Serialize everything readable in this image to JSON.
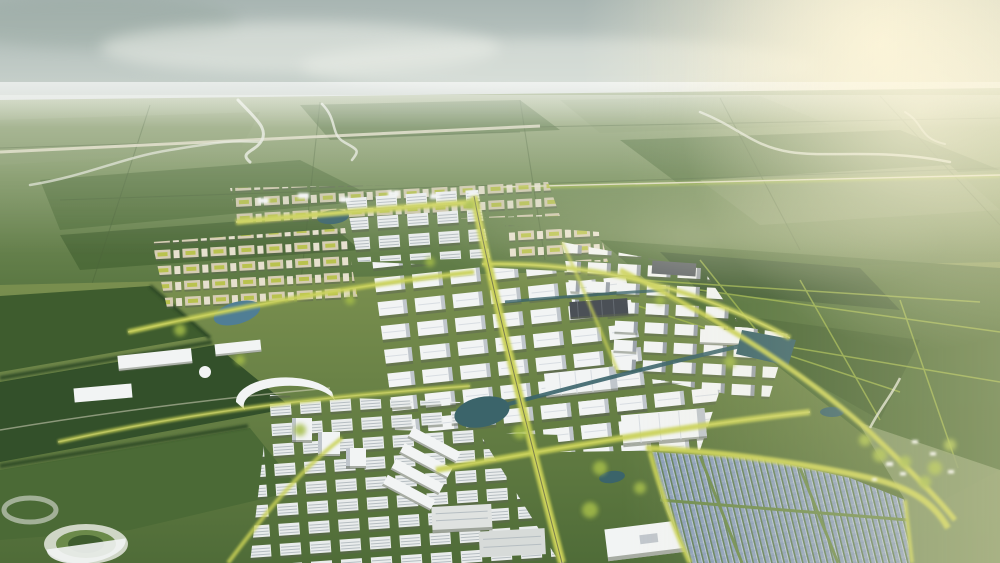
{
  "scene": {
    "type": "aerial-architectural-rendering",
    "description": "Bird's-eye 3D rendering of a green masterplanned industrial park city: white warehouse grids and office blocks threaded with yellow tree-lined boulevards and canals, beige courtyard housing, a landscaped campus with a circular landmark, sports fields, a large blue solar farm at lower right, and flat farmland with winding rivers stretching to a hazy bright horizon.",
    "regions": [
      {
        "name": "sky",
        "label": "hazy bright sky with sun glow at upper right"
      },
      {
        "name": "far-plain",
        "label": "flat farmland with rivers and expressway"
      },
      {
        "name": "east-farmland",
        "label": "hedged green fields east of the city"
      },
      {
        "name": "residential-district",
        "label": "beige courtyard housing blocks"
      },
      {
        "name": "warehouse-districts",
        "label": "white logistics warehouse grids"
      },
      {
        "name": "office-district",
        "label": "mid-rise office slabs"
      },
      {
        "name": "campus",
        "label": "landscaped campus with circular landmark"
      },
      {
        "name": "sports-fields",
        "label": "dark green pitches and farm plots"
      },
      {
        "name": "boulevards",
        "label": "yellow tree-lined avenues"
      },
      {
        "name": "water",
        "label": "lakes, ponds and canals"
      },
      {
        "name": "solar-farm",
        "label": "photovoltaic panel field"
      },
      {
        "name": "hamlet",
        "label": "sunlit village among trees"
      }
    ]
  },
  "colors": {
    "sky_top": "#a8b5b2",
    "sky_mid": "#c3cdc8",
    "sky_low": "#dbe0d5",
    "cloud_dark": "#93a49c",
    "cloud_light": "#eef1ea",
    "sun_glow": "#fdf6dc",
    "warm_light": "#f6ecc3",
    "far_hi": "#9fae85",
    "far_mid": "#78905c",
    "far_low": "#5a7742",
    "field_dark": "#3e5c2e",
    "field_deep": "#33502a",
    "field_green": "#4b6a36",
    "field_light": "#85996a",
    "dev_hi": "#7c9150",
    "dev_low": "#4f6c38",
    "tree_yellow": "#c9d155",
    "tree_lime": "#a5bd49",
    "tree_dark": "#2f4a26",
    "road_light": "#e4dfc9",
    "river": "#e2e6d9",
    "roof_white": "#f2f4f4",
    "roof_shade": "#c0c6cc",
    "roof_grey": "#9aa1a9",
    "roof_dark": "#4b5056",
    "wall_beige": "#d6cdb4",
    "courtyard": "#b9c24e",
    "shadow": "#5c6452",
    "water": "#3b646a",
    "water_blue": "#507e95",
    "solar_base": "#8da0bc",
    "solar_light": "#c2cdda",
    "solar_dark": "#6d82a0",
    "ridge_line": "#d8dde2",
    "window_line": "#b6bec2"
  }
}
